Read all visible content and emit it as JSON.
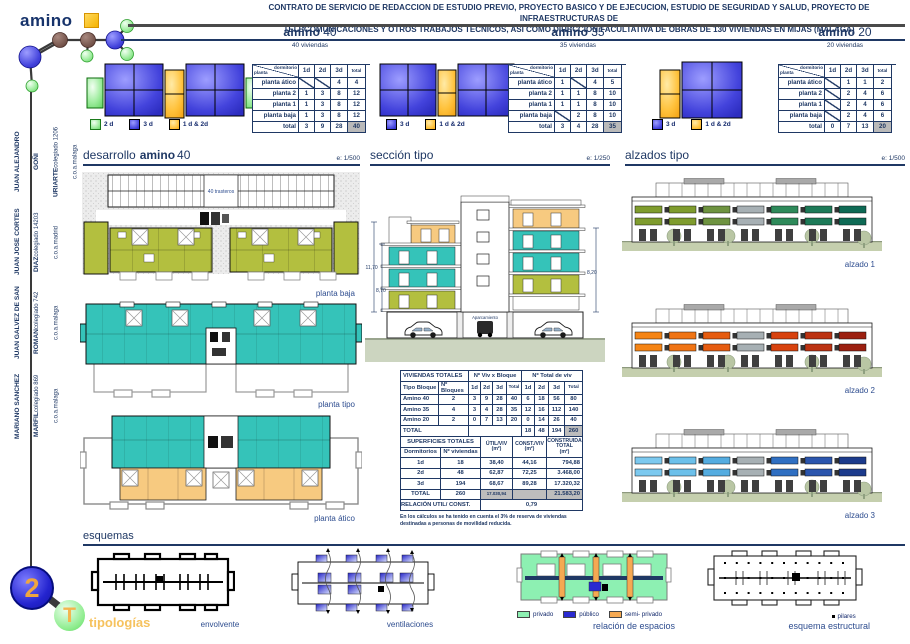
{
  "header": {
    "logo_text": "amino",
    "title_line1": "CONTRATO DE SERVICIO DE REDACCION DE ESTUDIO PREVIO, PROYECTO BASICO Y DE EJECUCION, ESTUDIO DE SEGURIDAD Y SALUD, PROYECTO DE INFRAESTRUCTURAS DE",
    "title_line2": "TELECOMUNICACIONES Y OTROS TRABAJOS TÉCNICOS, ASI COMO DIRECCION FACULTATIVA DE OBRAS DE 130 VIVIENDAS EN MIJAS (MALAGA)"
  },
  "columns": [
    {
      "brand": "amino",
      "number": "40",
      "subtitle": "40 viviendas"
    },
    {
      "brand": "amino",
      "number": "35",
      "subtitle": "35 viviendas"
    },
    {
      "brand": "amino",
      "number": "20",
      "subtitle": "20 viviendas"
    }
  ],
  "unit_tables": [
    {
      "corner_top": "dormitorio",
      "corner_bottom": "planta",
      "cols": [
        "1d",
        "2d",
        "3d",
        "total"
      ],
      "rows": [
        {
          "label": "planta ático",
          "values": [
            null,
            null,
            "4",
            "4"
          ]
        },
        {
          "label": "planta 2",
          "values": [
            "1",
            "3",
            "8",
            "12"
          ]
        },
        {
          "label": "planta 1",
          "values": [
            "1",
            "3",
            "8",
            "12"
          ]
        },
        {
          "label": "planta baja",
          "values": [
            "1",
            "3",
            "8",
            "12"
          ]
        },
        {
          "label": "total",
          "values": [
            "3",
            "9",
            "28",
            "40"
          ],
          "is_total": true
        }
      ],
      "legend": [
        {
          "label": "2 d"
        },
        {
          "label": "3 d"
        },
        {
          "label": "1 d & 2d"
        }
      ]
    },
    {
      "corner_top": "dormitorio",
      "corner_bottom": "planta",
      "cols": [
        "1d",
        "2d",
        "3d",
        "total"
      ],
      "rows": [
        {
          "label": "planta ático",
          "values": [
            "1",
            null,
            "4",
            "5"
          ]
        },
        {
          "label": "planta 2",
          "values": [
            "1",
            "1",
            "8",
            "10"
          ]
        },
        {
          "label": "planta 1",
          "values": [
            "1",
            "1",
            "8",
            "10"
          ]
        },
        {
          "label": "planta baja",
          "values": [
            null,
            "2",
            "8",
            "10"
          ]
        },
        {
          "label": "total",
          "values": [
            "3",
            "4",
            "28",
            "35"
          ],
          "is_total": true
        }
      ],
      "legend": [
        {
          "label": "3 d"
        },
        {
          "label": "1 d & 2d"
        }
      ]
    },
    {
      "corner_top": "dormitorio",
      "corner_bottom": "planta",
      "cols": [
        "1d",
        "2d",
        "3d",
        "total"
      ],
      "rows": [
        {
          "label": "planta ático",
          "values": [
            null,
            "1",
            "1",
            "2"
          ]
        },
        {
          "label": "planta 2",
          "values": [
            null,
            "2",
            "4",
            "6"
          ]
        },
        {
          "label": "planta 1",
          "values": [
            null,
            "2",
            "4",
            "6"
          ]
        },
        {
          "label": "planta baja",
          "values": [
            null,
            "2",
            "4",
            "6"
          ]
        },
        {
          "label": "total",
          "values": [
            "0",
            "7",
            "13",
            "20"
          ],
          "is_total": true
        }
      ],
      "legend": [
        {
          "label": "3 d"
        },
        {
          "label": "1 d & 2d"
        }
      ]
    }
  ],
  "sections": {
    "desarrollo": {
      "title": "desarrollo",
      "brand": "amino",
      "number": "40",
      "scale": "e: 1/500",
      "plan_labels": [
        "planta baja",
        "planta tipo",
        "planta ático"
      ],
      "trasteros_label": "40 trasteros"
    },
    "seccion": {
      "title": "sección tipo",
      "scale": "e: 1/250",
      "parking_label": "Aparcamiento",
      "dims": [
        "11,70",
        "8,70",
        "8,20"
      ]
    },
    "alzados": {
      "title": "alzados tipo",
      "scale": "e: 1/500",
      "labels": [
        "alzado 1",
        "alzado 2",
        "alzado 3"
      ]
    }
  },
  "viviendas_totales": {
    "title": "VIVIENDAS TOTALES",
    "group_headers": [
      "Nº Viv x Bloque",
      "Nº Total de viv"
    ],
    "col_headers": [
      "Tipo Bloque",
      "Nº Bloques",
      "1d",
      "2d",
      "3d",
      "Total",
      "1d",
      "2d",
      "3d",
      "Total"
    ],
    "rows": [
      {
        "tipo": "Amino 40",
        "bloques": "2",
        "viv": [
          "3",
          "9",
          "28",
          "40"
        ],
        "total": [
          "6",
          "18",
          "56",
          "80"
        ]
      },
      {
        "tipo": "Amino 35",
        "bloques": "4",
        "viv": [
          "3",
          "4",
          "28",
          "35"
        ],
        "total": [
          "12",
          "16",
          "112",
          "140"
        ]
      },
      {
        "tipo": "Amino 20",
        "bloques": "2",
        "viv": [
          "0",
          "7",
          "13",
          "20"
        ],
        "total": [
          "0",
          "14",
          "26",
          "40"
        ]
      }
    ],
    "total_row": {
      "label": "TOTAL",
      "values": [
        "18",
        "48",
        "194",
        "260"
      ]
    }
  },
  "superficies_totales": {
    "title": "SUPERFICIES TOTALES",
    "col_headers": [
      "ÚTIL/VIV\n(m²)",
      "CONST./VIV\n(m²)",
      "CONSTRUIDA\nTOTAL\n(m²)"
    ],
    "sub_headers": [
      "Dormitorios",
      "Nº viviendas"
    ],
    "rows": [
      {
        "dorm": "1d",
        "viviendas": "18",
        "util": "38,40",
        "const": "44,16",
        "construida": "794,88"
      },
      {
        "dorm": "2d",
        "viviendas": "48",
        "util": "62,87",
        "const": "72,25",
        "construida": "3.468,00"
      },
      {
        "dorm": "3d",
        "viviendas": "194",
        "util": "68,67",
        "const": "89,28",
        "construida": "17.320,32"
      }
    ],
    "total_row": {
      "label": "TOTAL",
      "viviendas": "260",
      "util": "17.030,94",
      "construida": "21.583,20"
    },
    "relacion_label": "RELACIÓN  UTIL/ CONST.",
    "relacion_value": "0,79",
    "footnote": "En los cálculos se ha tenido en cuenta el 3% de reserva de viviendas destinadas a personas de movilidad reducida."
  },
  "esquemas": {
    "title": "esquemas",
    "items": [
      {
        "label": "envolvente"
      },
      {
        "label": "ventilaciones"
      },
      {
        "label": "relación de espacios",
        "legend": [
          {
            "label": "privado"
          },
          {
            "label": "público"
          },
          {
            "label": "semi- privado"
          }
        ]
      },
      {
        "label": "esquema estructural",
        "legend_label": "pilares"
      }
    ]
  },
  "architects": [
    {
      "name": "JUAN ALEJANDRO GOÑI URIARTE",
      "detail": "colegiado 1206 c.o.a.malaga"
    },
    {
      "name": "JUAN JOSE CORTES DIAZ",
      "detail": "colegiado 14203 c.o.a.madrid"
    },
    {
      "name": "JUAN GALVEZ DE SAN ROMAN",
      "detail": "colegiado 742 c.o.a.malaga"
    },
    {
      "name": "MARIANO SANCHEZ MARFIL",
      "detail": "colegiado 869 c.o.a.malaga"
    }
  ],
  "badge": {
    "number": "2",
    "letter": "T",
    "label": "tipologías"
  },
  "palette": {
    "navy": "#1f3864",
    "label_blue": "#2e4d8f",
    "accent_orange": "#f6c25e",
    "legend_green": "#a0eda0",
    "legend_blue": "#4343dc",
    "legend_orange": "#ffc23c",
    "plan_olive": "#b3bf3f",
    "plan_teal": "#35c3b9",
    "plan_atico_orange": "#f7ca80",
    "esquema_green": "#8df0b2",
    "esquema_blue": "#2a2ad0",
    "esquema_orange": "#f5a952",
    "alzado1_greens": [
      "#7f9c2e",
      "#2e8a5a",
      "#0e6a55"
    ],
    "alzado2_oranges": [
      "#f58414",
      "#d8420e",
      "#9c2010"
    ],
    "alzado3_blues": [
      "#7cc9ef",
      "#2f6fc2",
      "#1c3b8c"
    ]
  }
}
